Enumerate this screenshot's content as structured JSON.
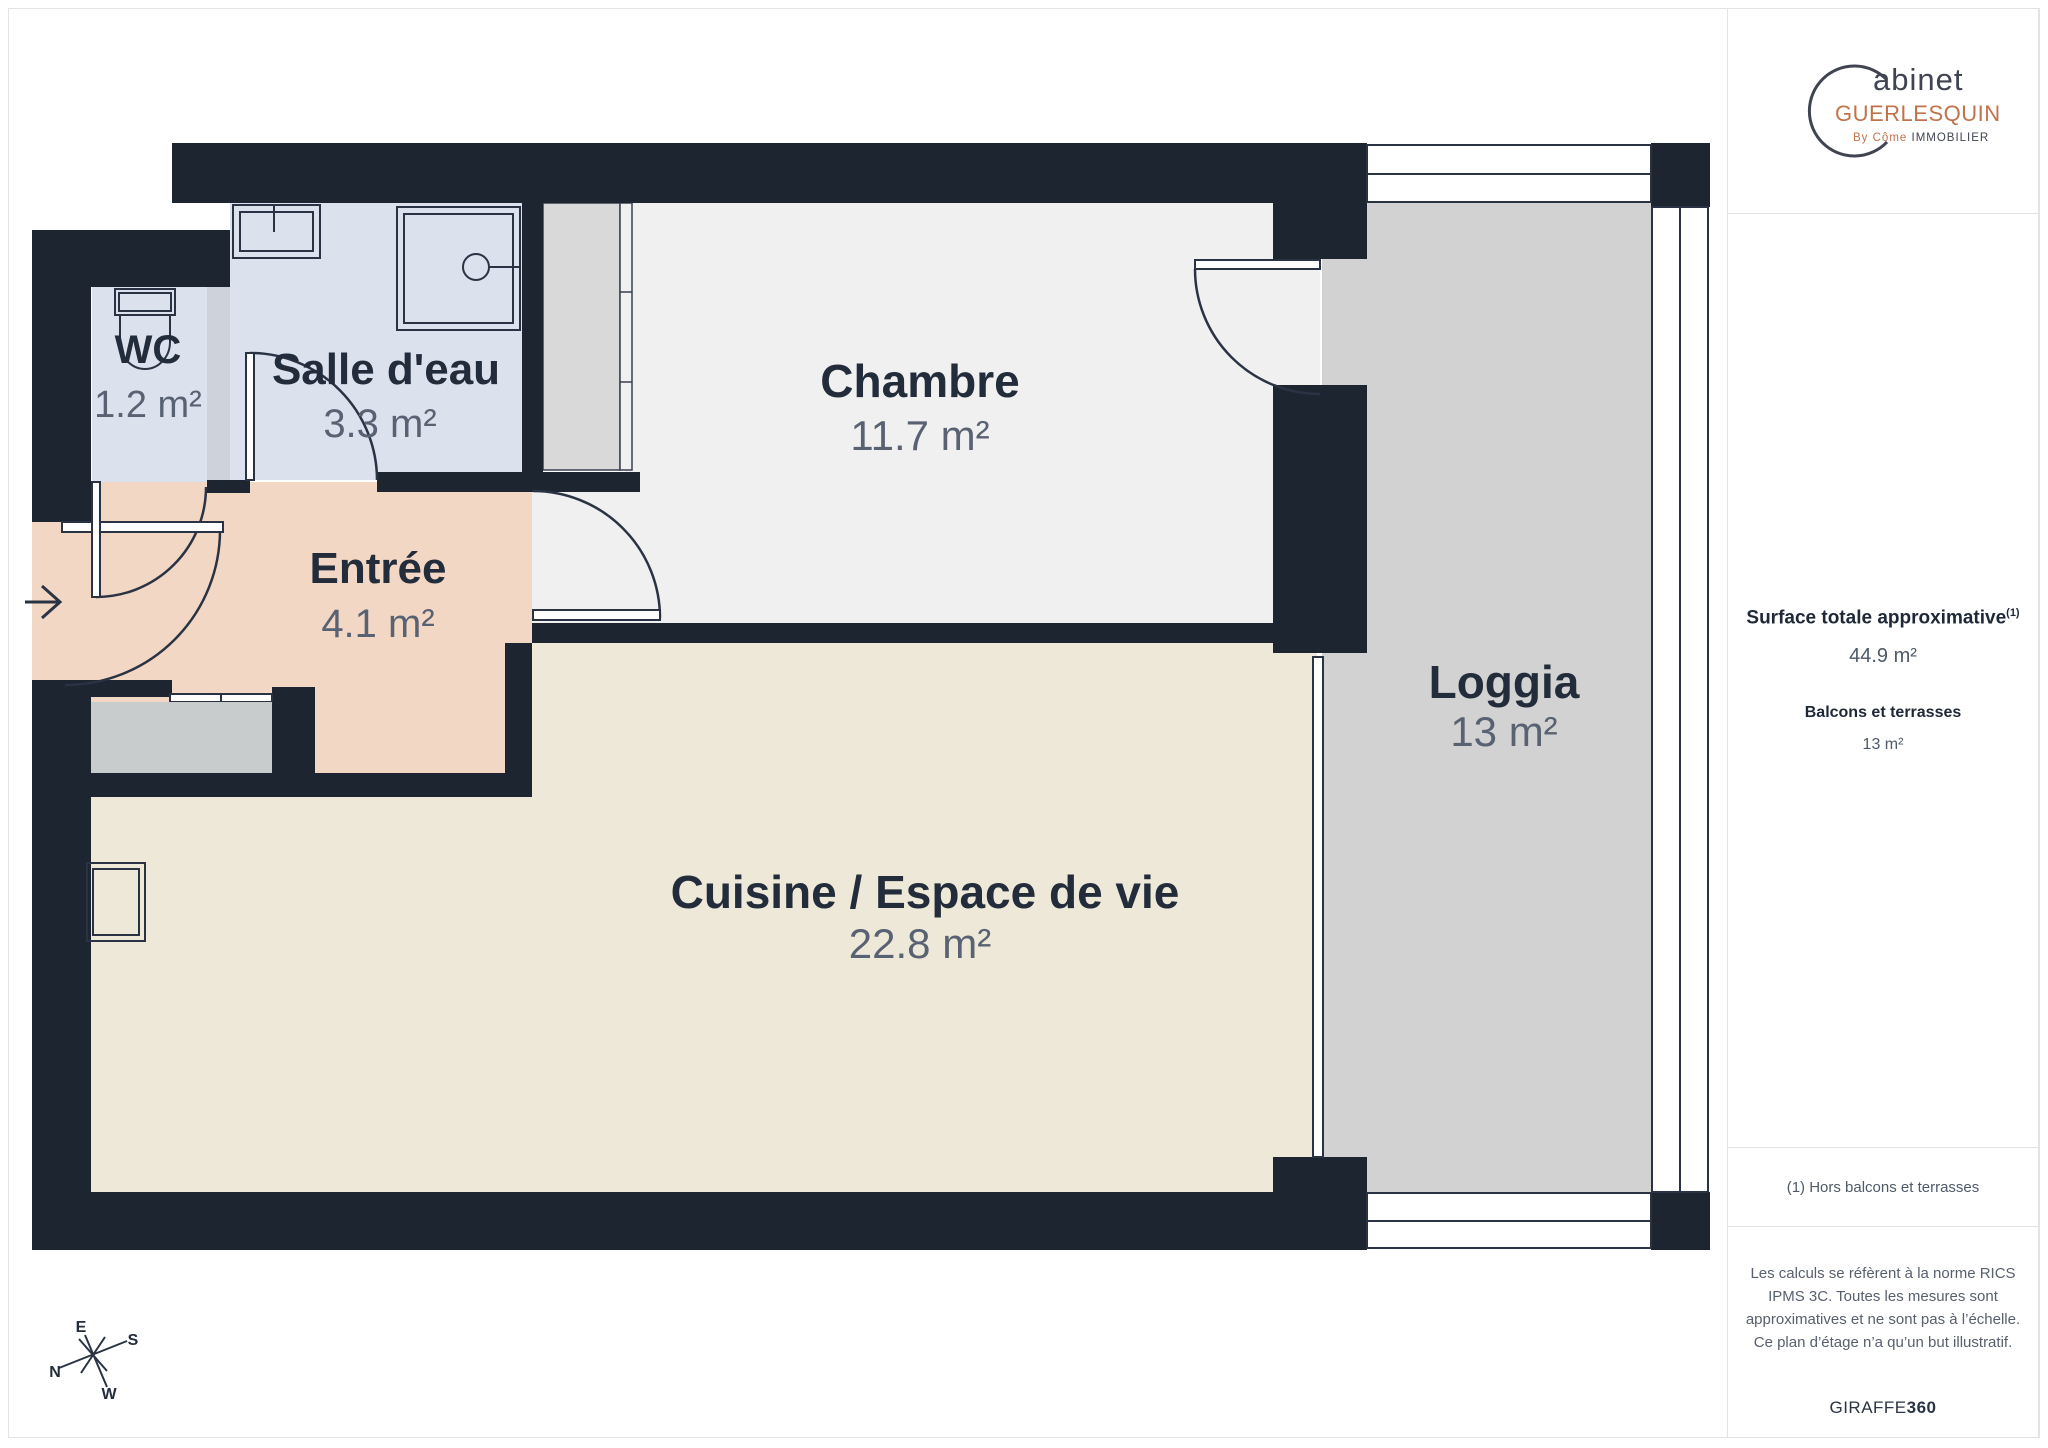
{
  "floor_plan": {
    "rooms": [
      {
        "id": "wc",
        "label": "WC",
        "area": "1.2 m²"
      },
      {
        "id": "salle_deau",
        "label": "Salle d'eau",
        "area": "3.3 m²"
      },
      {
        "id": "entree",
        "label": "Entrée",
        "area": "4.1 m²"
      },
      {
        "id": "chambre",
        "label": "Chambre",
        "area": "11.7 m²"
      },
      {
        "id": "cuisine",
        "label": "Cuisine / Espace de vie",
        "area": "22.8 m²"
      },
      {
        "id": "loggia",
        "label": "Loggia",
        "area": "13 m²"
      }
    ],
    "compass": {
      "north": "N",
      "east": "E",
      "south": "S",
      "west": "W"
    },
    "colors": {
      "wall": "#1d2531",
      "chambre_floor": "#f0f0f1",
      "cuisine_floor": "#eee8d8",
      "entree_floor": "#f3d7c5",
      "wet_room_floor": "#dce1ee",
      "loggia_floor": "#d2d2d2",
      "wardrobe": "#d9d9d9",
      "logo_orange": "#c0734a"
    }
  },
  "sidebar": {
    "logo": {
      "cabinet": "abinet",
      "name": "GUERLESQUIN",
      "by": "By Côme",
      "suffix": "IMMOBILIER"
    },
    "surface": {
      "title": "Surface totale approximative",
      "superscript": "(1)",
      "value": "44.9 m²"
    },
    "balcony": {
      "title": "Balcons et terrasses",
      "value": "13 m²"
    },
    "footnote": "(1) Hors balcons et terrasses",
    "legal": "Les calculs se réfèrent à la norme RICS IPMS 3C. Toutes les mesures sont approximatives et ne sont pas à l’échelle. Ce plan d’étage n’a qu’un but illustratif.",
    "brand": {
      "prefix": "GIRAFFE",
      "suffix": "360"
    }
  }
}
